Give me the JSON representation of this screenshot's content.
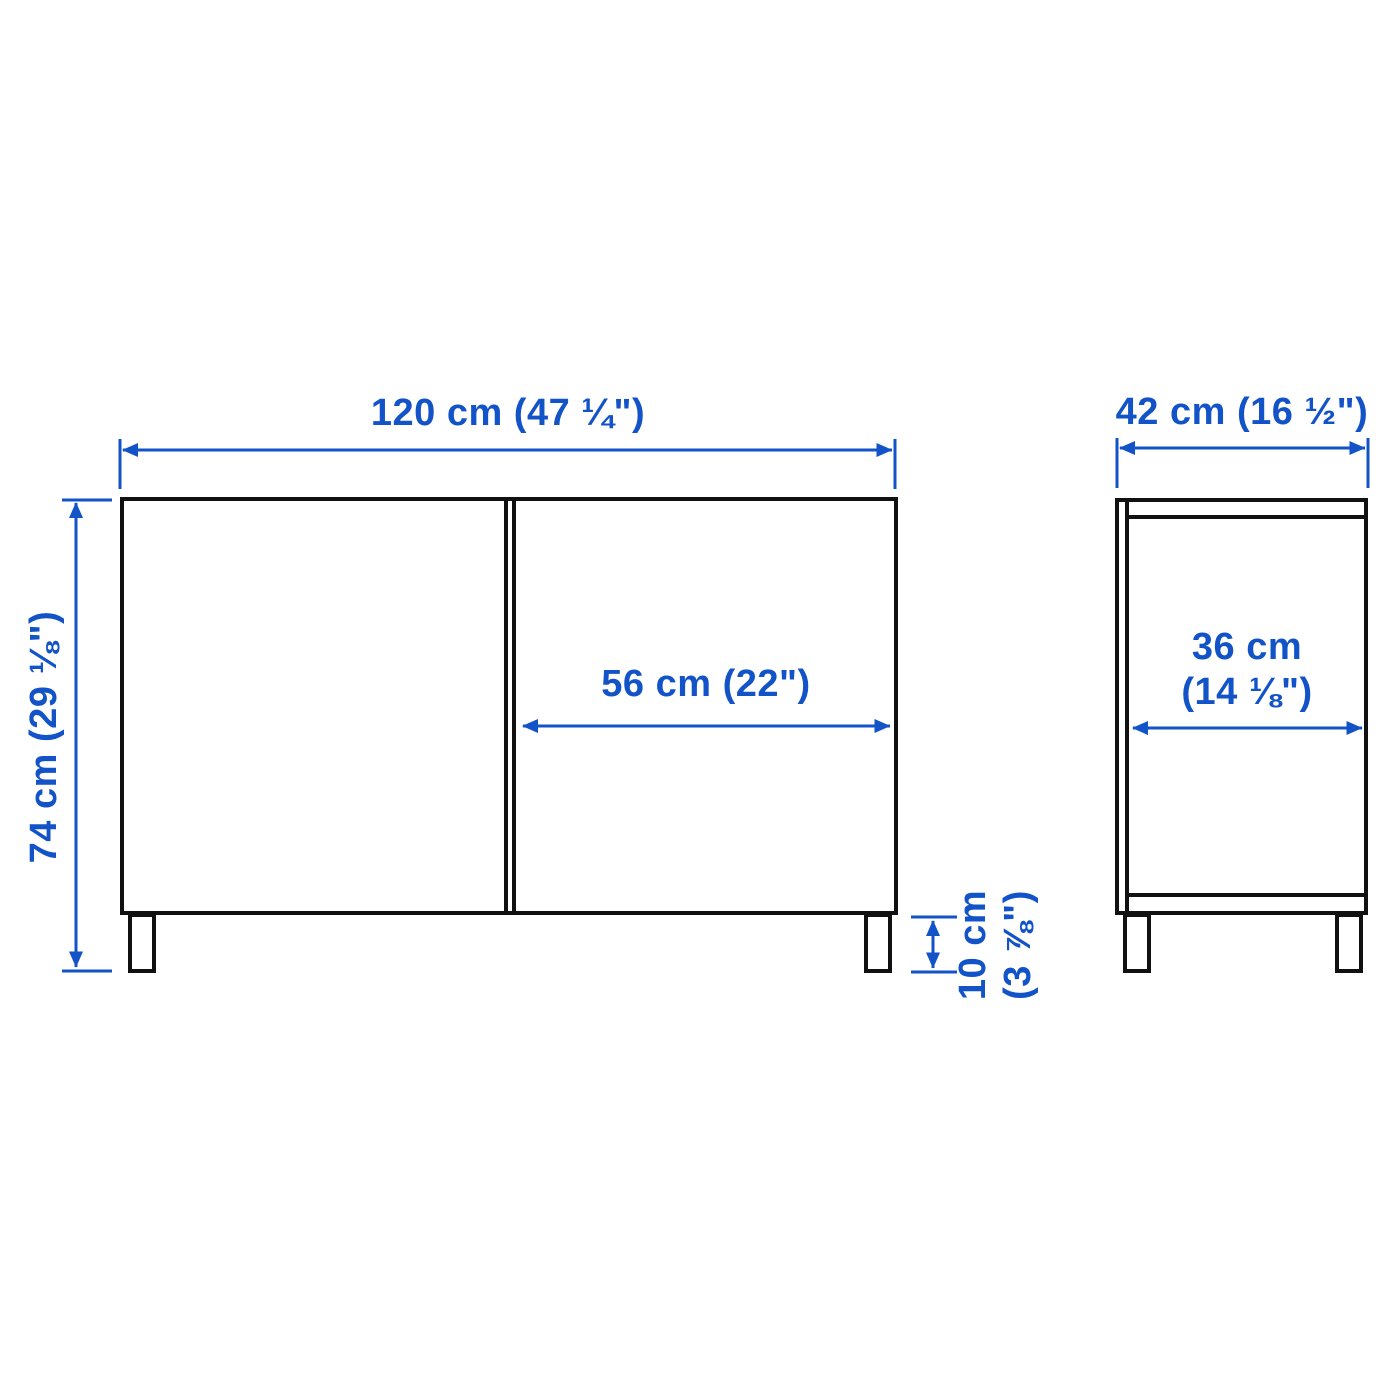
{
  "diagram": {
    "type": "furniture-dimension-diagram",
    "views": [
      "front",
      "side"
    ],
    "colors": {
      "dimension_blue": "#1353c8",
      "outline_black": "#111111",
      "background": "#ffffff"
    },
    "front_view": {
      "overall_width": {
        "label": "120 cm (47 ¼\")",
        "cm": 120,
        "inches": "47 ¼"
      },
      "overall_height": {
        "label": "74 cm (29 ⅛\")",
        "cm": 74,
        "inches": "29 ⅛"
      },
      "door_width": {
        "label": "56 cm (22\")",
        "cm": 56,
        "inches": "22"
      },
      "leg_height": {
        "label_line1": "10 cm",
        "label_line2": "(3 ⅞\")",
        "cm": 10,
        "inches": "3 ⅞"
      }
    },
    "side_view": {
      "overall_depth": {
        "label": "42 cm (16 ½\")",
        "cm": 42,
        "inches": "16 ½"
      },
      "inner_depth": {
        "label_line1": "36 cm",
        "label_line2": "(14 ⅛\")",
        "cm": 36,
        "inches": "14 ⅛"
      }
    }
  }
}
